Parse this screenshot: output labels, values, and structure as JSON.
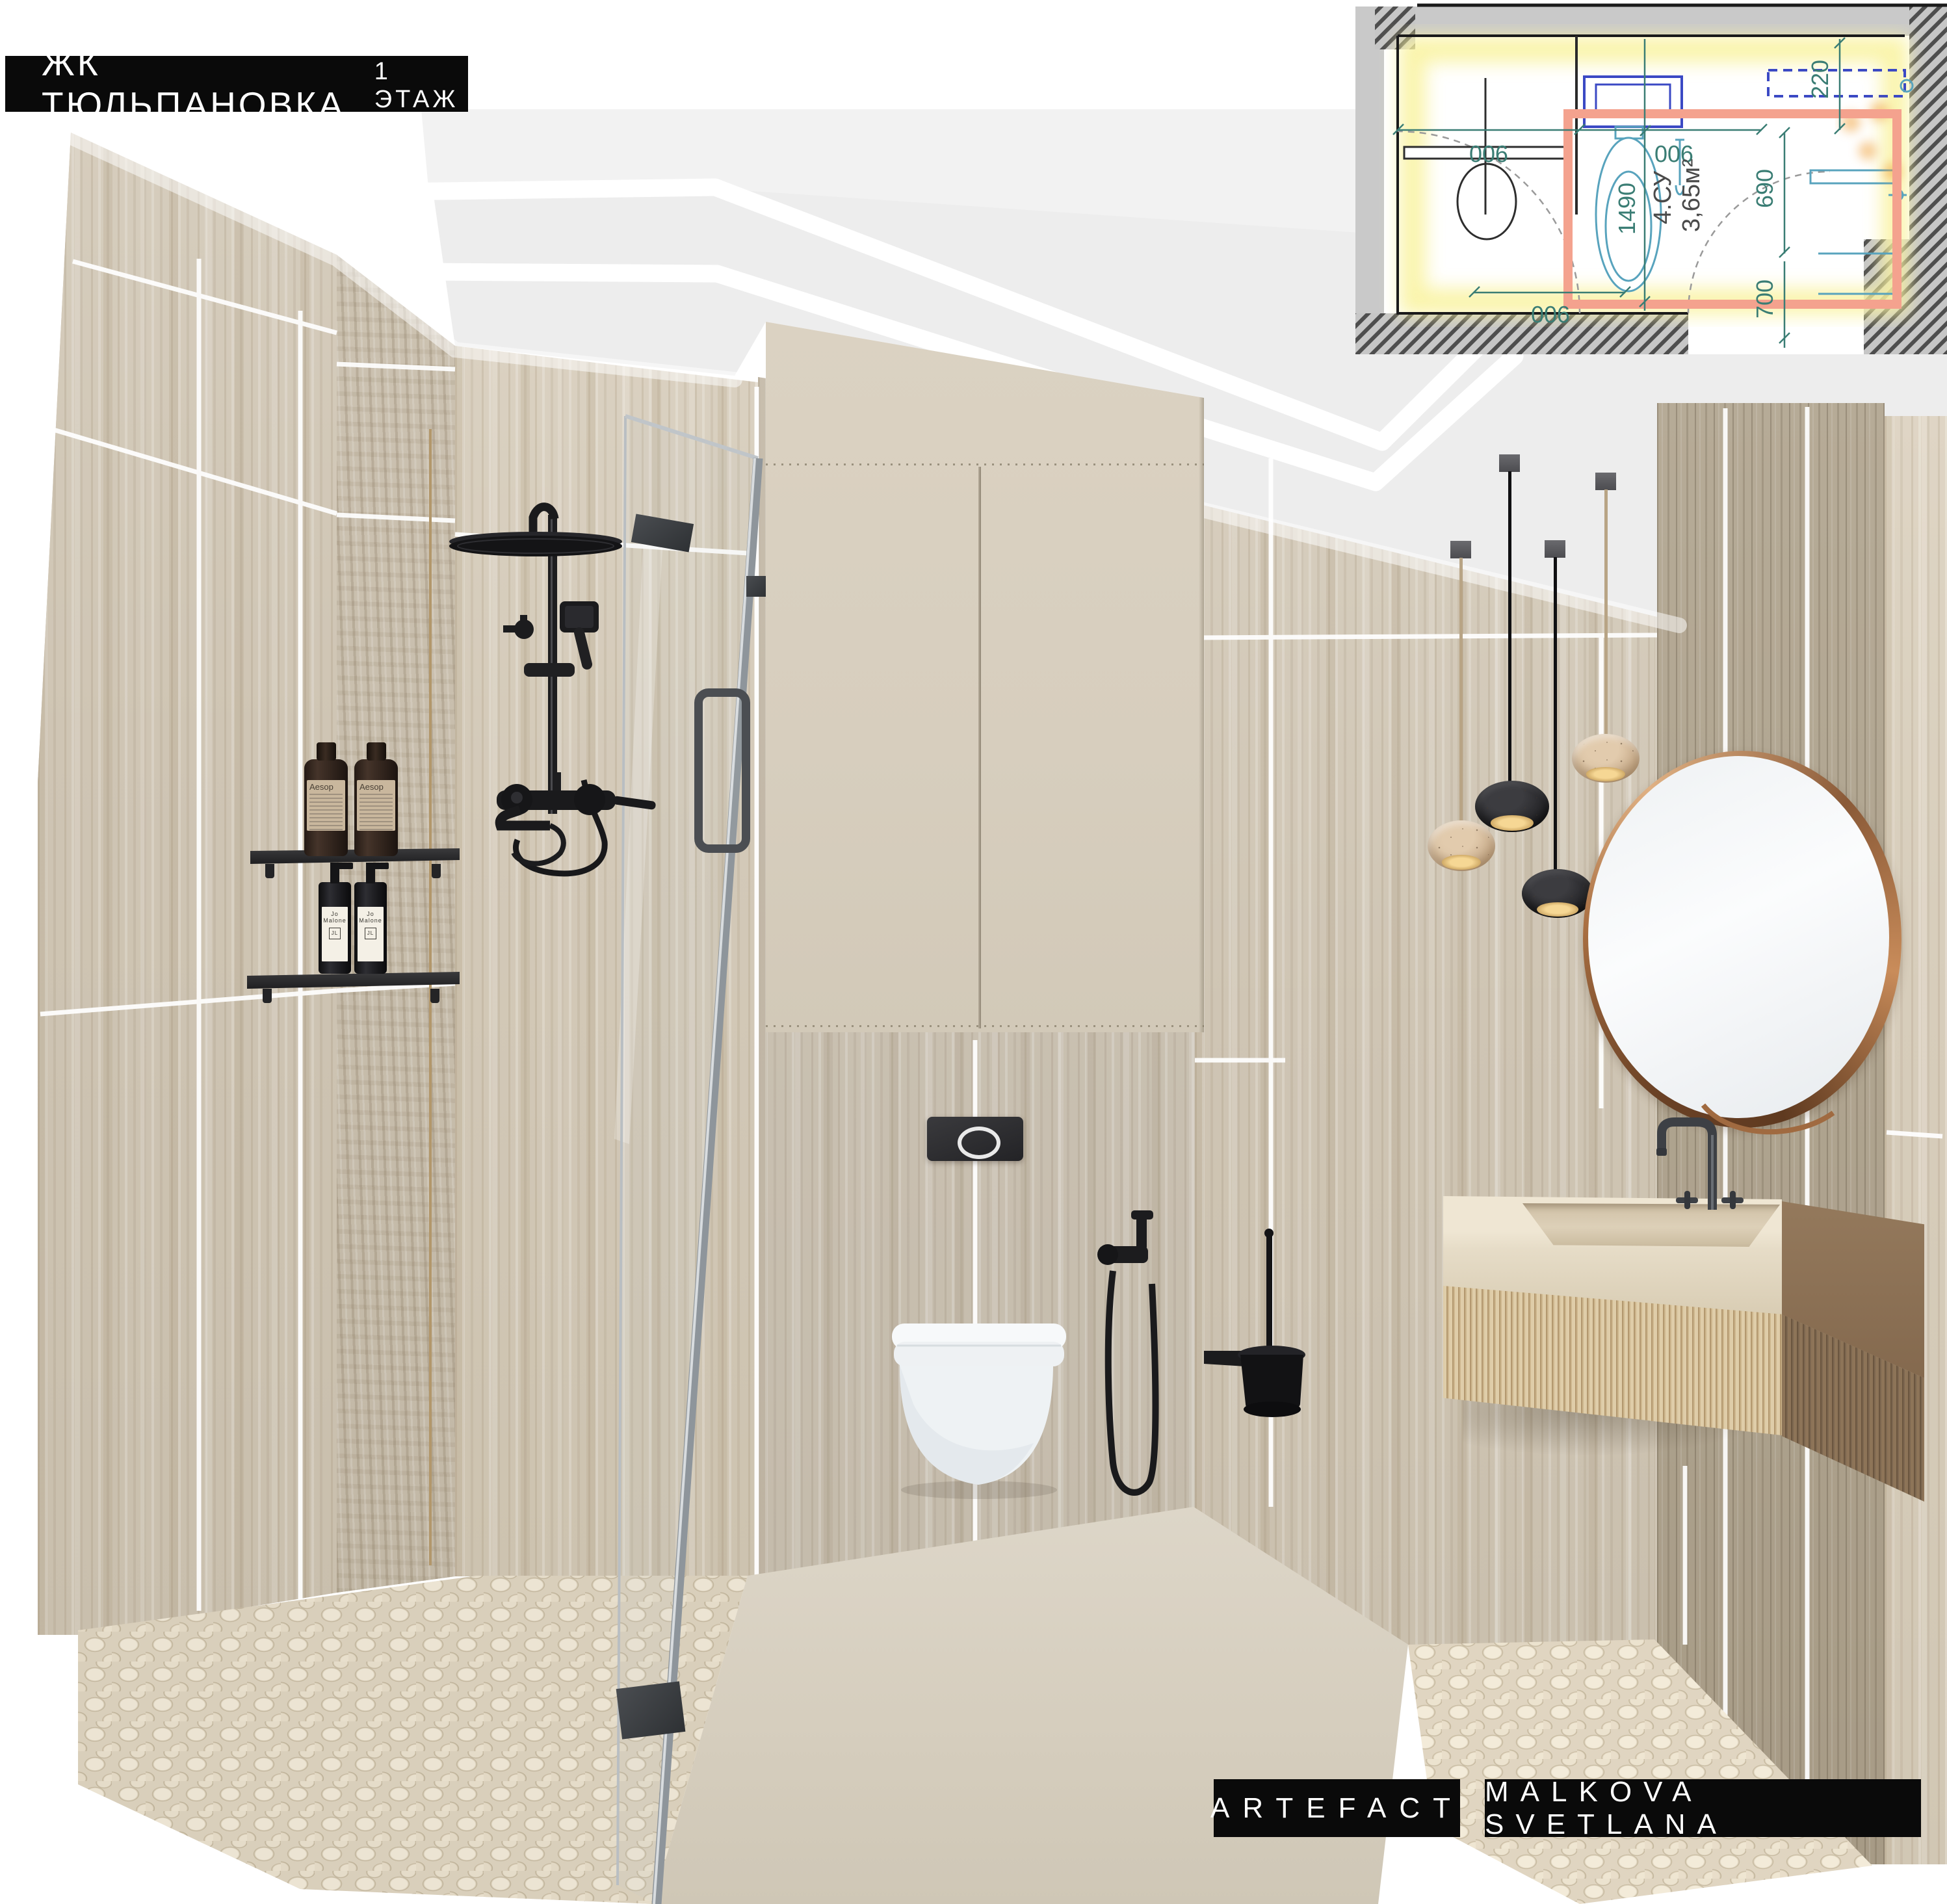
{
  "header": {
    "project": "ЖК ТЮЛЬПАНОВКА",
    "floor": "1 ЭТАЖ"
  },
  "credits": {
    "studio": "ARTEFACT",
    "designer": "MALKOVA SVETLANA"
  },
  "floor_plan": {
    "room_name": "4.СУ",
    "room_area": "3,65м²",
    "dims": {
      "top_left": "900",
      "top_right": "900",
      "height_main": "1490",
      "right_top": "220",
      "right_mid": "690",
      "right_bottom": "700",
      "bottom": "900"
    }
  },
  "products": {
    "toner_brand": "Aesop",
    "soap_brand": "Jo Malone"
  },
  "colors": {
    "badge_bg": "#0a0a0a",
    "badge_text": "#ffffff",
    "ceiling": "#ededed",
    "travertine": "#cfc5b4",
    "cabinet": "#d8cfbf",
    "fixture_black": "#1c1c1e",
    "mirror_rim_bronze": "#b87b4e",
    "plan_dim_teal": "#3a7d74",
    "plan_room_outline_salmon": "#f4a28e",
    "plan_fixture_blue": "#3b49c4",
    "plan_highlight_yellow": "#f9f3a0",
    "vanity_wood": "#8d7258",
    "pendant_stone": "#d3b89a"
  }
}
